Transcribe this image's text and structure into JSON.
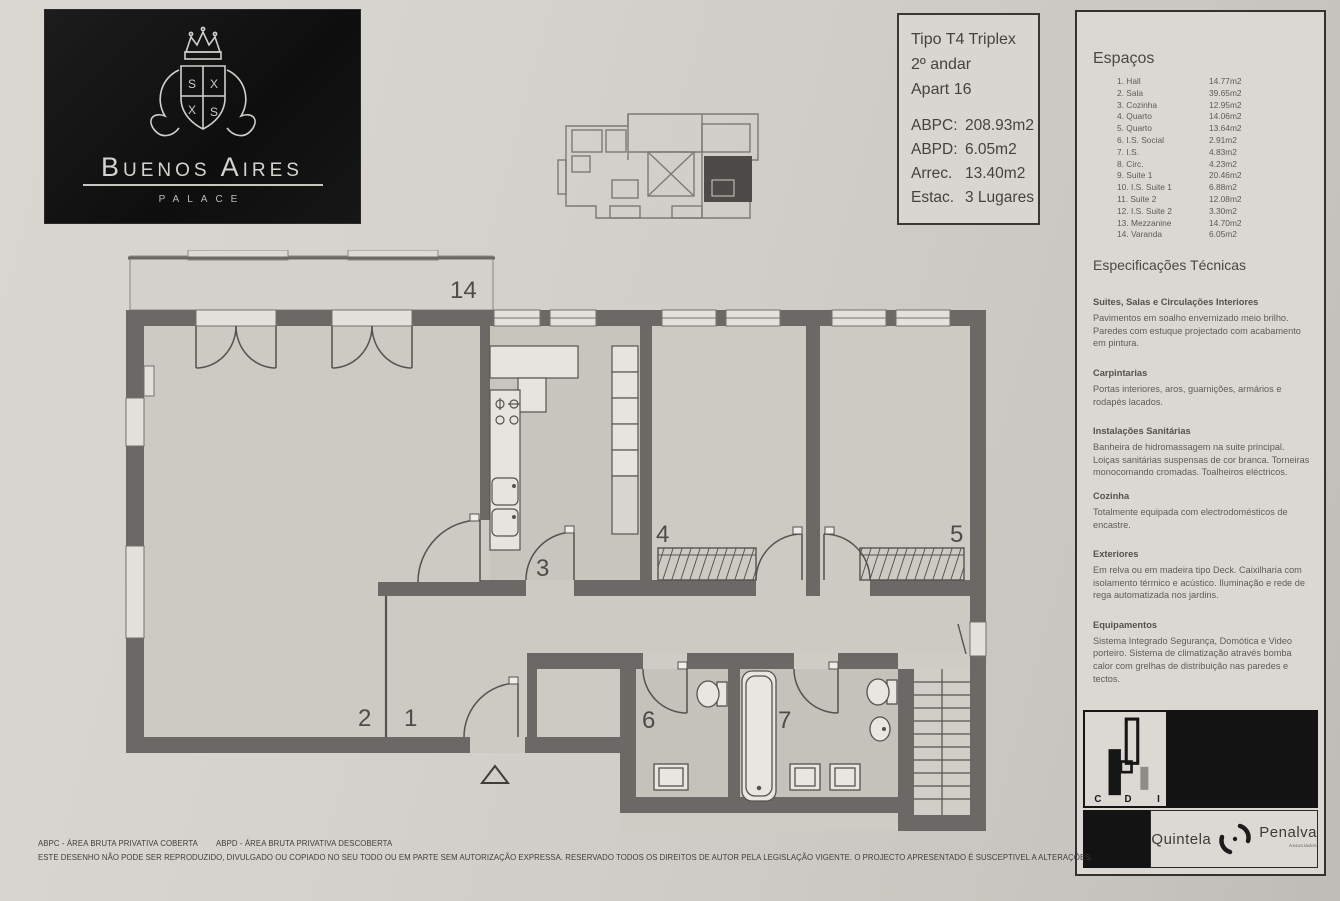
{
  "logo": {
    "name": "Buenos Aires",
    "subtitle": "PALACE"
  },
  "info_box": {
    "type": "Tipo T4 Triplex",
    "floor": "2º andar",
    "apartment": "Apart 16",
    "metrics": [
      {
        "label": "ABPC:",
        "value": "208.93m2"
      },
      {
        "label": "ABPD:",
        "value": "6.05m2"
      },
      {
        "label": "Arrec.",
        "value": "13.40m2"
      },
      {
        "label": "Estac.",
        "value": "3 Lugares"
      }
    ]
  },
  "spaces": {
    "title": "Espaços",
    "items": [
      {
        "label": "1. Hall",
        "area": "14.77m2"
      },
      {
        "label": "2. Sala",
        "area": "39.65m2"
      },
      {
        "label": "3. Cozinha",
        "area": "12.95m2"
      },
      {
        "label": "4. Quarto",
        "area": "14.06m2"
      },
      {
        "label": "5. Quarto",
        "area": "13.64m2"
      },
      {
        "label": "6. I.S. Social",
        "area": "2.91m2"
      },
      {
        "label": "7. I.S.",
        "area": "4.83m2"
      },
      {
        "label": "8. Circ.",
        "area": "4.23m2"
      },
      {
        "label": "9. Suite 1",
        "area": "20.46m2"
      },
      {
        "label": "10. I.S. Suite 1",
        "area": "6.88m2"
      },
      {
        "label": "11. Suite 2",
        "area": "12.08m2"
      },
      {
        "label": "12. I.S. Suite 2",
        "area": "3.30m2"
      },
      {
        "label": "13. Mezzanine",
        "area": "14.70m2"
      },
      {
        "label": "14. Varanda",
        "area": "6.05m2"
      }
    ]
  },
  "specs": {
    "title": "Especificações Técnicas",
    "sections": [
      {
        "heading": "Suites, Salas e Circulações Interiores",
        "body": "Pavimentos em soalho envernizado meio brilho. Paredes com estuque projectado com acabamento em pintura."
      },
      {
        "heading": "Carpintarias",
        "body": "Portas interiores, aros, guarnições, armários e rodapés lacados."
      },
      {
        "heading": "Instalações Sanitárias",
        "body": "Banheira de hidromassagem na suite principal. Loiças sanitárias suspensas de cor branca. Torneiras monocomando cromadas. Toalheiros eléctricos."
      },
      {
        "heading": "Cozinha",
        "body": "Totalmente equipada com electrodomésticos de encastre."
      },
      {
        "heading": "Exteriores",
        "body": "Em relva ou em madeira tipo Deck. Caixilharia com isolamento térmico e acústico. Iluminação e rede de rega automatizada nos jardins."
      },
      {
        "heading": "Equipamentos",
        "body": "Sistema Integrado Segurança, Domótica e Video porteiro. Sistema de climatização através bomba calor com grelhas de distribuição nas paredes e tectos."
      }
    ]
  },
  "floor_plan": {
    "labels": {
      "varanda": "14",
      "sala": "2",
      "hall": "1",
      "cozinha": "3",
      "quarto_4": "4",
      "quarto_5": "5",
      "is_6": "6",
      "is_7": "7"
    }
  },
  "brands": {
    "cdi_letters": {
      "c": "C",
      "d": "D",
      "i": "I"
    },
    "quintela": "Quintela",
    "penalva": "Penalva",
    "penalva_sub": "Associados"
  },
  "footer": {
    "legend_abpc": "ABPC - ÁREA BRUTA PRIVATIVA COBERTA",
    "legend_abpd": "ABPD - ÁREA BRUTA PRIVATIVA DESCOBERTA",
    "disclaimer": "ESTE DESENHO NÃO PODE SER REPRODUZIDO, DIVULGADO OU COPIADO NO SEU TODO OU EM PARTE SEM AUTORIZAÇÃO EXPRESSA. RESERVADO TODOS OS DIREITOS DE AUTOR PELA LEGISLAÇÃO VIGENTE. O PROJECTO APRESENTADO É SUSCEPTIVEL A ALTERAÇÕES."
  },
  "colors": {
    "wall": "#6c6865",
    "paper": "#d6d3ce",
    "ink_black": "#141414"
  }
}
